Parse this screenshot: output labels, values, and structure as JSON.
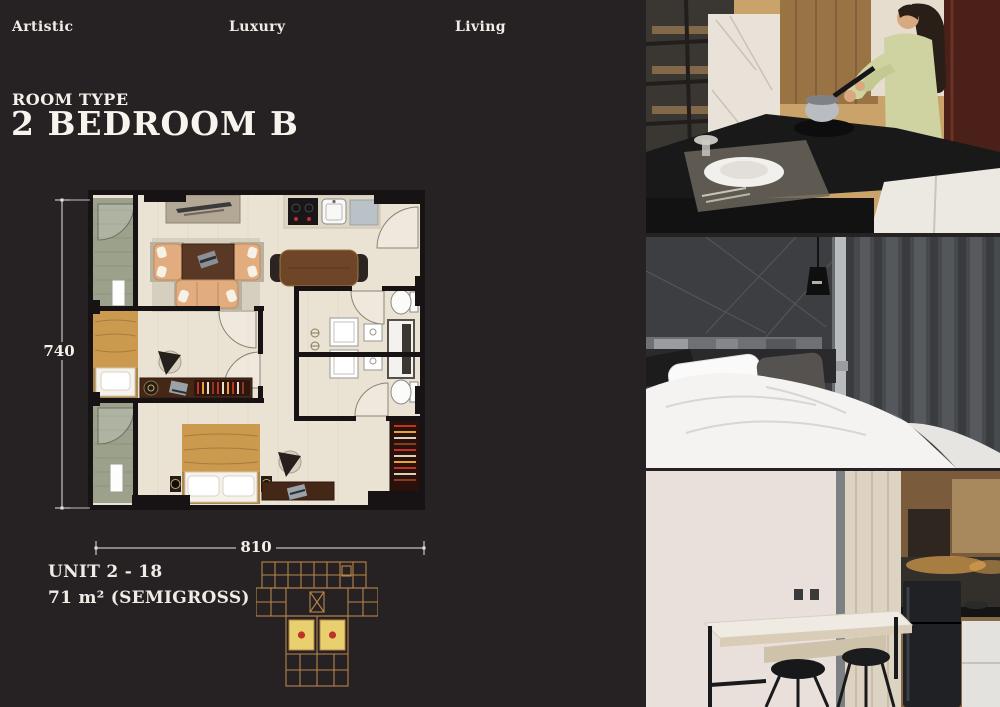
{
  "page": {
    "background": "#262223",
    "text_color": "#f0ede9"
  },
  "header": {
    "words": [
      {
        "label": "Artistic"
      },
      {
        "label": "Luxury"
      },
      {
        "label": "Living"
      }
    ]
  },
  "title": {
    "eyebrow": "ROOM TYPE",
    "name": "2 BEDROOM B"
  },
  "floor_plan": {
    "height_label": "740",
    "width_label": "810",
    "colors": {
      "wall": "#171314",
      "floor": "#eae3d3",
      "balcony": "#9ba18b",
      "bed_cover": "#cb9a4f",
      "wood_table": "#6f4527",
      "sofa": "#e2ac7e",
      "desk": "#452718"
    }
  },
  "unit_info": {
    "unit": "UNIT 2 - 18",
    "area": "71 m² (SEMIGROSS)"
  },
  "key_plan": {
    "colors": {
      "outline": "#b8854a",
      "highlight": "#e8d06e",
      "marker": "#c03028"
    },
    "highlighted_units": 2
  },
  "photos": [
    {
      "name": "kitchen-cooking"
    },
    {
      "name": "bedroom"
    },
    {
      "name": "bar-counter-kitchen"
    }
  ]
}
